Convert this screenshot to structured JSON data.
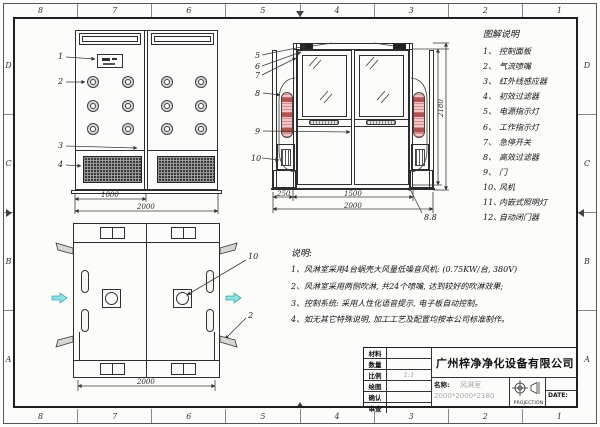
{
  "frame": {
    "zone_columns": [
      "8",
      "7",
      "6",
      "5",
      "4",
      "3",
      "2",
      "1"
    ],
    "zone_rows": [
      "D",
      "C",
      "B",
      "A"
    ]
  },
  "legend": {
    "title": "图解说明",
    "items": [
      {
        "num": "1、",
        "label": "控制面板"
      },
      {
        "num": "2、",
        "label": "气流喷嘴"
      },
      {
        "num": "3、",
        "label": "红外线感应器"
      },
      {
        "num": "4、",
        "label": "初效过滤器"
      },
      {
        "num": "5、",
        "label": "电源指示灯"
      },
      {
        "num": "6、",
        "label": "工作指示灯"
      },
      {
        "num": "7、",
        "label": "急停开关"
      },
      {
        "num": "8、",
        "label": "高效过滤器"
      },
      {
        "num": "9、",
        "label": "门"
      },
      {
        "num": "10、",
        "label": "风机"
      },
      {
        "num": "11、",
        "label": "内嵌式照明灯"
      },
      {
        "num": "12、",
        "label": "自动闭门器"
      }
    ]
  },
  "notes": {
    "title": "说明:",
    "items": [
      {
        "num": "1、",
        "text": "风淋室采用4台蜗壳大风量低噪音风机: (0.75KW/台, 380V)"
      },
      {
        "num": "2、",
        "text": "风淋室采用两侧吹淋, 共24个喷嘴, 达到较好的吹淋效果;"
      },
      {
        "num": "3、",
        "text": "控制系统: 采用人性化语音提示, 电子板自动控制。"
      },
      {
        "num": "4、",
        "text": "如无其它特殊说明, 加工工艺及配置均按本公司标准制作。"
      }
    ]
  },
  "views": {
    "interior": {
      "leaders": [
        "1",
        "2",
        "3",
        "4"
      ],
      "dim_half": "1000",
      "dim_total": "2000"
    },
    "exterior": {
      "leaders": [
        "5",
        "6",
        "7",
        "8",
        "9",
        "10"
      ],
      "corner_label": "8.8",
      "dim_left": "250",
      "dim_mid": "1500",
      "dim_total": "2000",
      "dim_height": "2180"
    },
    "plan": {
      "leader_fan": "10",
      "leader_corner": "2",
      "dim_total": "2000"
    }
  },
  "title_block": {
    "rows": [
      {
        "label": "材料",
        "value": ""
      },
      {
        "label": "数量",
        "value": ""
      },
      {
        "label": "比例",
        "value": "1:1"
      },
      {
        "label": "绘图",
        "value": ""
      },
      {
        "label": "确认",
        "value": ""
      },
      {
        "label": "审查",
        "value": ""
      }
    ],
    "company": "广州梓净净化设备有限公司",
    "name_label": "名称:",
    "product_name": "风淋室",
    "product_size": "2000*2000*2180",
    "projection_label": "PROJECTION",
    "date_label": "DATE:"
  },
  "colors": {
    "line": "#2e2e2e",
    "filter_pink": "#f0c6c6",
    "filter_red": "#b4524e",
    "airflow_cyan": "#8fe0e0",
    "gray_text": "#a8a8a8"
  }
}
